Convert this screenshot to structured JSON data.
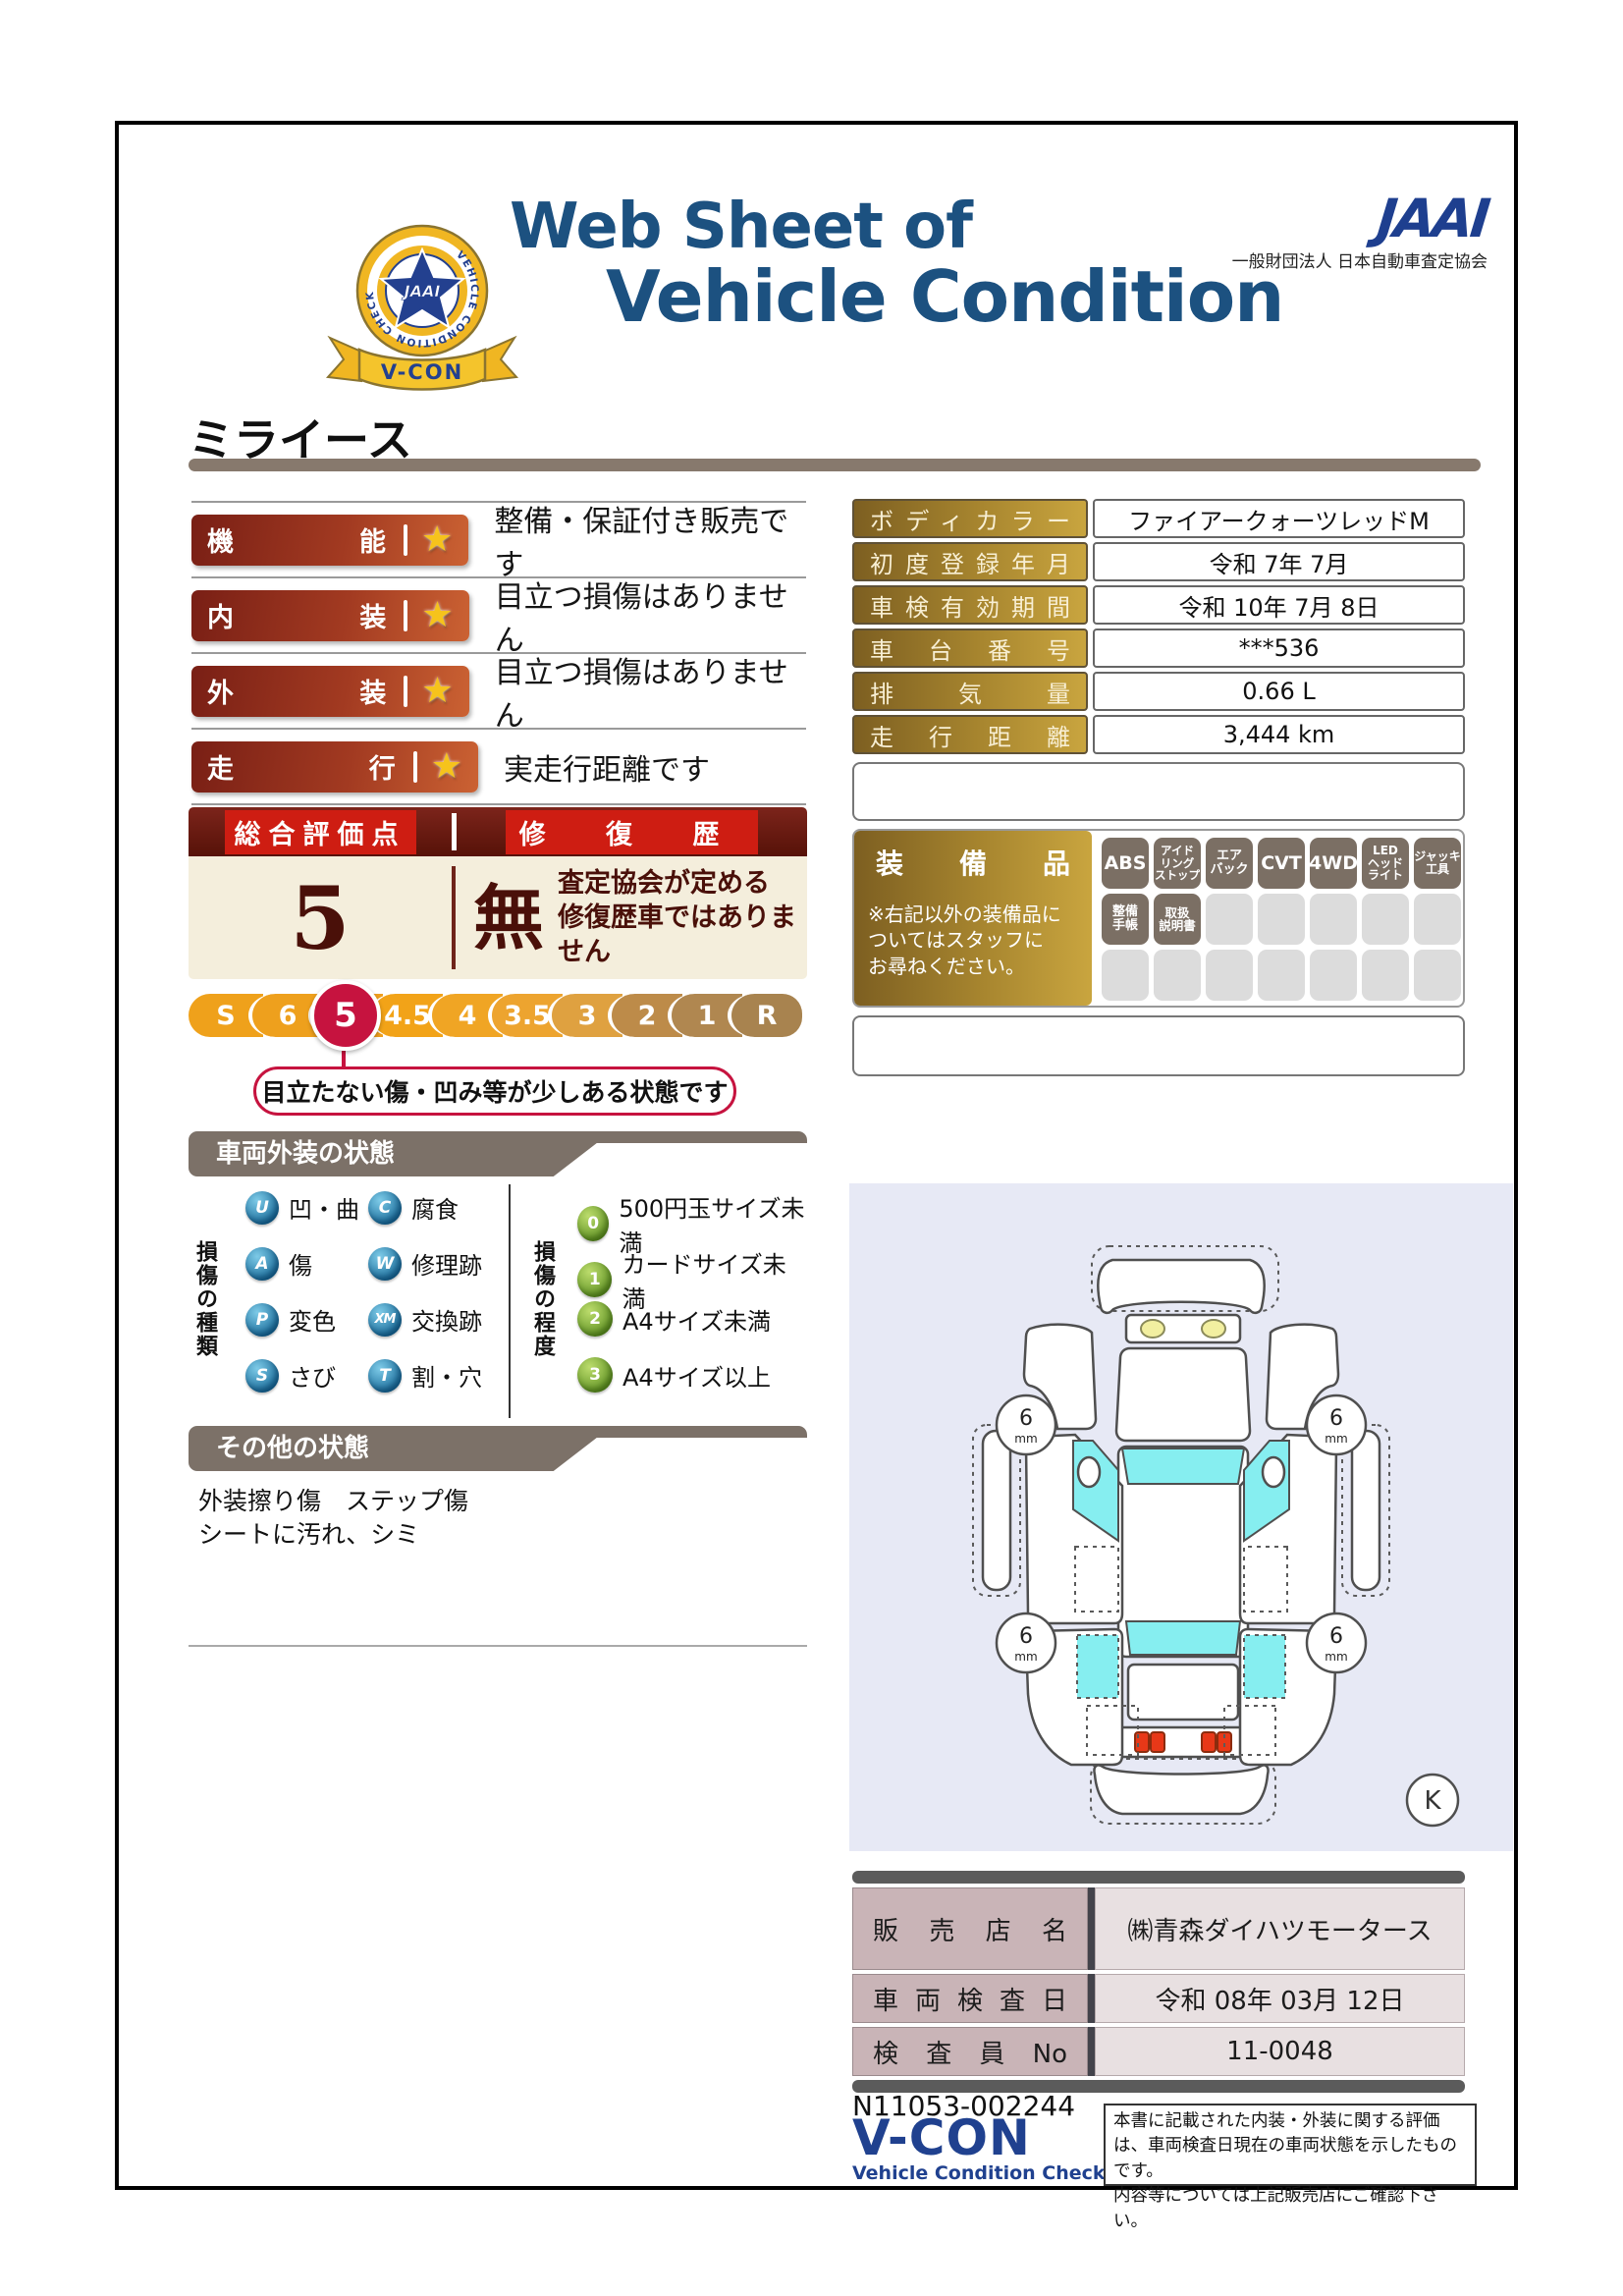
{
  "header": {
    "title_line1": "Web Sheet of",
    "title_line2": "Vehicle Condition",
    "jaai_logo": "JAAI",
    "jaai_subtitle": "一般財団法人 日本自動車査定協会",
    "seal": {
      "ring_text": "VEHICLE CONDITION CHECK SYSTEM",
      "star_text": "JAAI",
      "banner_text": "V-CON"
    }
  },
  "vehicle_name": "ミライース",
  "ratings": [
    {
      "label": "機能",
      "star": "★",
      "description": "整備・保証付き販売です"
    },
    {
      "label": "内装",
      "star": "★",
      "description": "目立つ損傷はありません"
    },
    {
      "label": "外装",
      "star": "★",
      "description": "目立つ損傷はありません"
    },
    {
      "label": "走行",
      "star": "★",
      "description": "実走行距離です"
    }
  ],
  "overall": {
    "score_header": "総合評価点",
    "repair_header": "修 復 歴",
    "score": "5",
    "repair_value": "無",
    "repair_note": "査定協会が定める\n修復歴車ではありません",
    "scale_labels": [
      "S",
      "6",
      "5",
      "4.5",
      "4",
      "3.5",
      "3",
      "2",
      "1",
      "R"
    ],
    "selected_label": "5",
    "callout": "目立たない傷・凹み等が少しある状態です"
  },
  "info_table": [
    {
      "label": "ボディカラー",
      "value": "ファイアークォーツレッドM"
    },
    {
      "label": "初度登録年月",
      "value": "令和 7年 7月"
    },
    {
      "label": "車検有効期間",
      "value": "令和 10年 7月 8日"
    },
    {
      "label": "車台番号",
      "value": "***536"
    },
    {
      "label": "排気量",
      "value": "0.66 L"
    },
    {
      "label": "走行距離",
      "value": "3,444 km"
    }
  ],
  "equipment": {
    "title": "装備品",
    "note": "※右記以外の装備品に\nついてはスタッフに\nお尋ねください。",
    "badges": [
      "ABS",
      "アイド\nリング\nストップ",
      "エア\nバック",
      "CVT",
      "4WD",
      "LED\nヘッド\nライト",
      "ジャッキ\n工具",
      "整備\n手帳",
      "取扱\n説明書"
    ]
  },
  "exterior_section": {
    "header": "車両外装の状態",
    "type_title": "損傷の種類",
    "types": [
      {
        "code": "U",
        "label": "凹・曲"
      },
      {
        "code": "A",
        "label": "傷"
      },
      {
        "code": "P",
        "label": "変色"
      },
      {
        "code": "S",
        "label": "さび"
      },
      {
        "code": "C",
        "label": "腐食"
      },
      {
        "code": "W",
        "label": "修理跡"
      },
      {
        "code": "XM",
        "label": "交換跡"
      },
      {
        "code": "T",
        "label": "割・穴"
      }
    ],
    "degree_title": "損傷の程度",
    "degrees": [
      {
        "code": "0",
        "label": "500円玉サイズ未満"
      },
      {
        "code": "1",
        "label": "カードサイズ未満"
      },
      {
        "code": "2",
        "label": "A4サイズ未満"
      },
      {
        "code": "3",
        "label": "A4サイズ以上"
      }
    ]
  },
  "other_section": {
    "header": "その他の状態",
    "notes": "外装擦り傷　ステップ傷\nシートに汚れ、シミ"
  },
  "diagram": {
    "tire_front_left": "6",
    "tire_front_right": "6",
    "tire_rear_left": "6",
    "tire_rear_right": "6",
    "tire_unit": "mm",
    "designation": "K"
  },
  "dealer": [
    {
      "label": "販売店名",
      "value": "㈱青森ダイハツモータース"
    },
    {
      "label": "車両検査日",
      "value": "令和 08年 03月 12日"
    },
    {
      "label": "検査員No",
      "value": "11-0048"
    }
  ],
  "footer": {
    "serial": "N11053-002244",
    "vcon": "V-CON",
    "vcon_sub": "Vehicle Condition Check System",
    "disclaimer": "本書に記載された内装・外装に関する評価は、車両検査日現在の車両状態を示したものです。\n内容等については上記販売店にご確認下さい。"
  },
  "colors": {
    "title_blue": "#1c5180",
    "jaai_blue": "#1e3f8f",
    "accent_red": "#ce1d12",
    "crimson": "#c6133f",
    "gold": "#c9a53f",
    "window_cyan": "#86eef0",
    "taillight_red": "#e83818"
  }
}
